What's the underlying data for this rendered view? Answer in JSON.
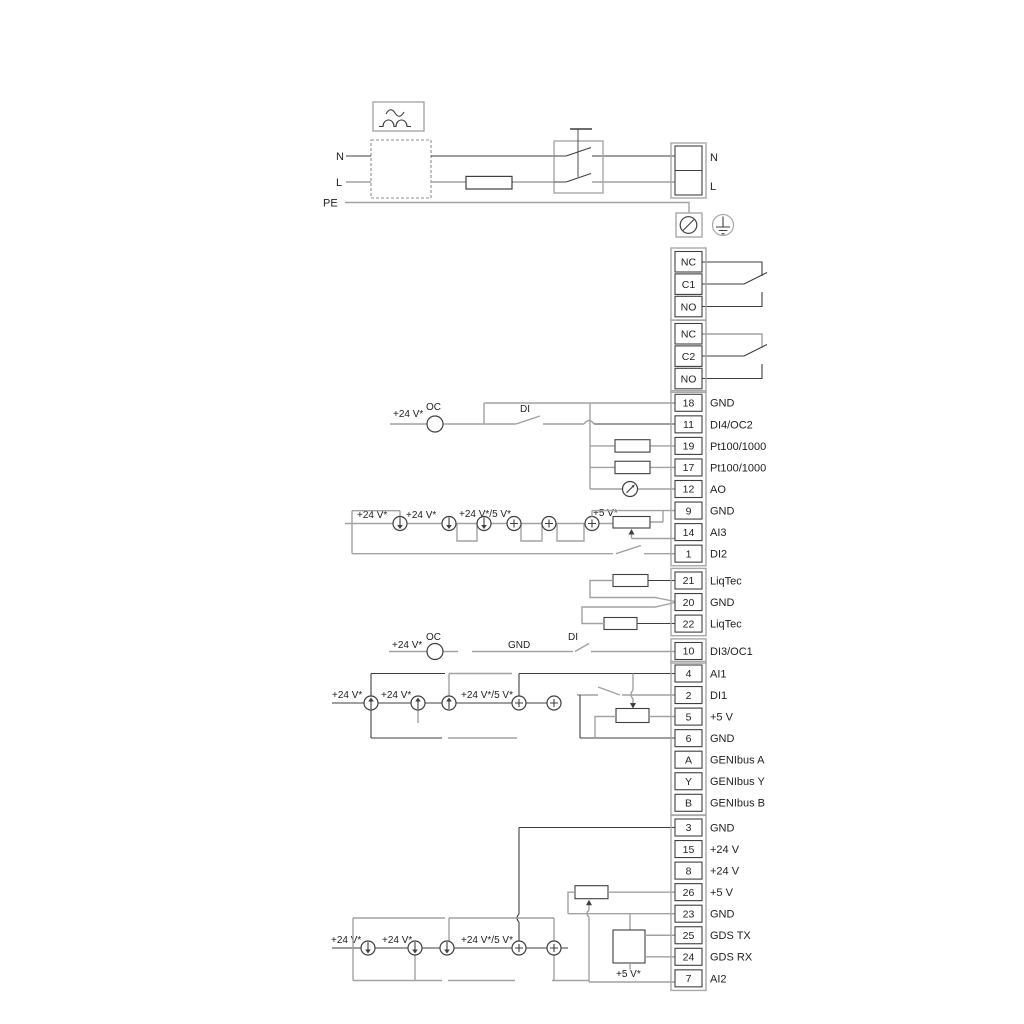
{
  "power": {
    "n_left": "N",
    "l_left": "L",
    "pe": "PE",
    "n_right": "N",
    "l_right": "L"
  },
  "relays": [
    {
      "cells": [
        "NC",
        "C1",
        "NO"
      ]
    },
    {
      "cells": [
        "NC",
        "C2",
        "NO"
      ]
    }
  ],
  "terminal_groups": [
    {
      "rows": [
        [
          "18",
          "GND"
        ],
        [
          "11",
          "DI4/OC2"
        ],
        [
          "19",
          "Pt100/1000"
        ],
        [
          "17",
          "Pt100/1000"
        ],
        [
          "12",
          "AO"
        ],
        [
          "9",
          "GND"
        ],
        [
          "14",
          "AI3"
        ],
        [
          "1",
          "DI2"
        ]
      ]
    },
    {
      "rows": [
        [
          "21",
          "LiqTec"
        ],
        [
          "20",
          "GND"
        ],
        [
          "22",
          "LiqTec"
        ]
      ]
    },
    {
      "rows": [
        [
          "10",
          "DI3/OC1"
        ]
      ]
    },
    {
      "rows": [
        [
          "4",
          "AI1"
        ],
        [
          "2",
          "DI1"
        ],
        [
          "5",
          "+5 V"
        ],
        [
          "6",
          "GND"
        ],
        [
          "A",
          "GENIbus A"
        ],
        [
          "Y",
          "GENIbus Y"
        ],
        [
          "B",
          "GENIbus B"
        ]
      ]
    },
    {
      "rows": [
        [
          "3",
          "GND"
        ],
        [
          "15",
          "+24 V"
        ],
        [
          "8",
          "+24 V"
        ],
        [
          "26",
          "+5 V"
        ],
        [
          "23",
          "GND"
        ],
        [
          "25",
          "GDS TX"
        ],
        [
          "24",
          "GDS RX"
        ],
        [
          "7",
          "AI2"
        ]
      ]
    }
  ],
  "annotations": {
    "di4_row": {
      "v24": "+24 V*",
      "oc": "OC",
      "di": "DI"
    },
    "ai3_row": {
      "v24_1": "+24 V*",
      "v24_2": "+24 V*",
      "v24_5v": "+24 V*/5 V*",
      "v5": "+5 V*"
    },
    "di3_row": {
      "v24": "+24 V*",
      "oc": "OC",
      "gnd": "GND",
      "di": "DI"
    },
    "ai1_row": {
      "v24_1": "+24 V*",
      "v24_2": "+24 V*",
      "v24_5v": "+24 V*/5 V*"
    },
    "ai2_row": {
      "v24_1": "+24 V*",
      "v24_2": "+24 V*",
      "v24_5v": "+24 V*/5 V*",
      "v5": "+5 V*"
    }
  }
}
